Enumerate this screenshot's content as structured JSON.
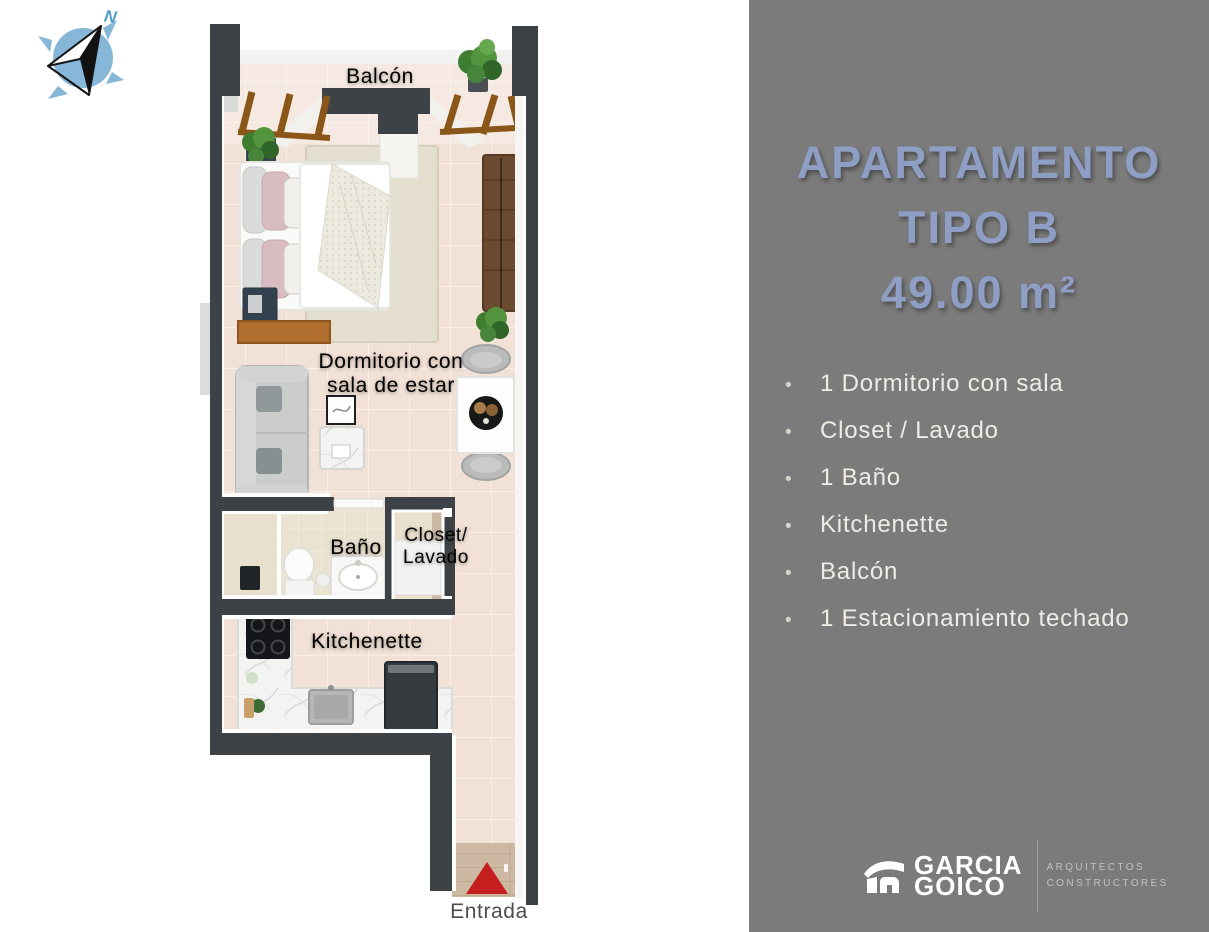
{
  "colors": {
    "sidebar_bg": "#7b7b7b",
    "title_text": "#8f9ec5",
    "feature_text": "#efece6",
    "bullet": "#d6d3cd",
    "plan_label": "#ffffff",
    "entrance_label": "#4a4e50",
    "wall": "#3d4247",
    "floor_tile": "#f1e1d6",
    "entrance_arrow": "#c41e1e",
    "compass_blue": "#87b7d8",
    "wood_accent": "#8a5718",
    "brand_text": "#ffffff",
    "tagline_text": "#c2c2c2"
  },
  "plan": {
    "compass": {
      "letter": "N"
    },
    "labels": {
      "balcony": "Balcón",
      "bedroom": [
        "Dormitorio con",
        "sala de estar"
      ],
      "bathroom": "Baño",
      "closet": [
        "Closet/",
        "Lavado"
      ],
      "kitchenette": "Kitchenette",
      "entrance": "Entrada"
    }
  },
  "sidebar": {
    "title_lines": [
      "APARTAMENTO",
      "TIPO B",
      "49.00 m²"
    ],
    "bullet_char": "•",
    "features": [
      "1 Dormitorio con sala",
      "Closet / Lavado",
      "1 Baño",
      "Kitchenette",
      "Balcón",
      "1 Estacionamiento techado"
    ],
    "logo": {
      "brand_lines": [
        "GARCIA",
        "GOICO"
      ],
      "tagline_lines": [
        "ARQUITECTOS",
        "CONSTRUCTORES"
      ]
    }
  }
}
